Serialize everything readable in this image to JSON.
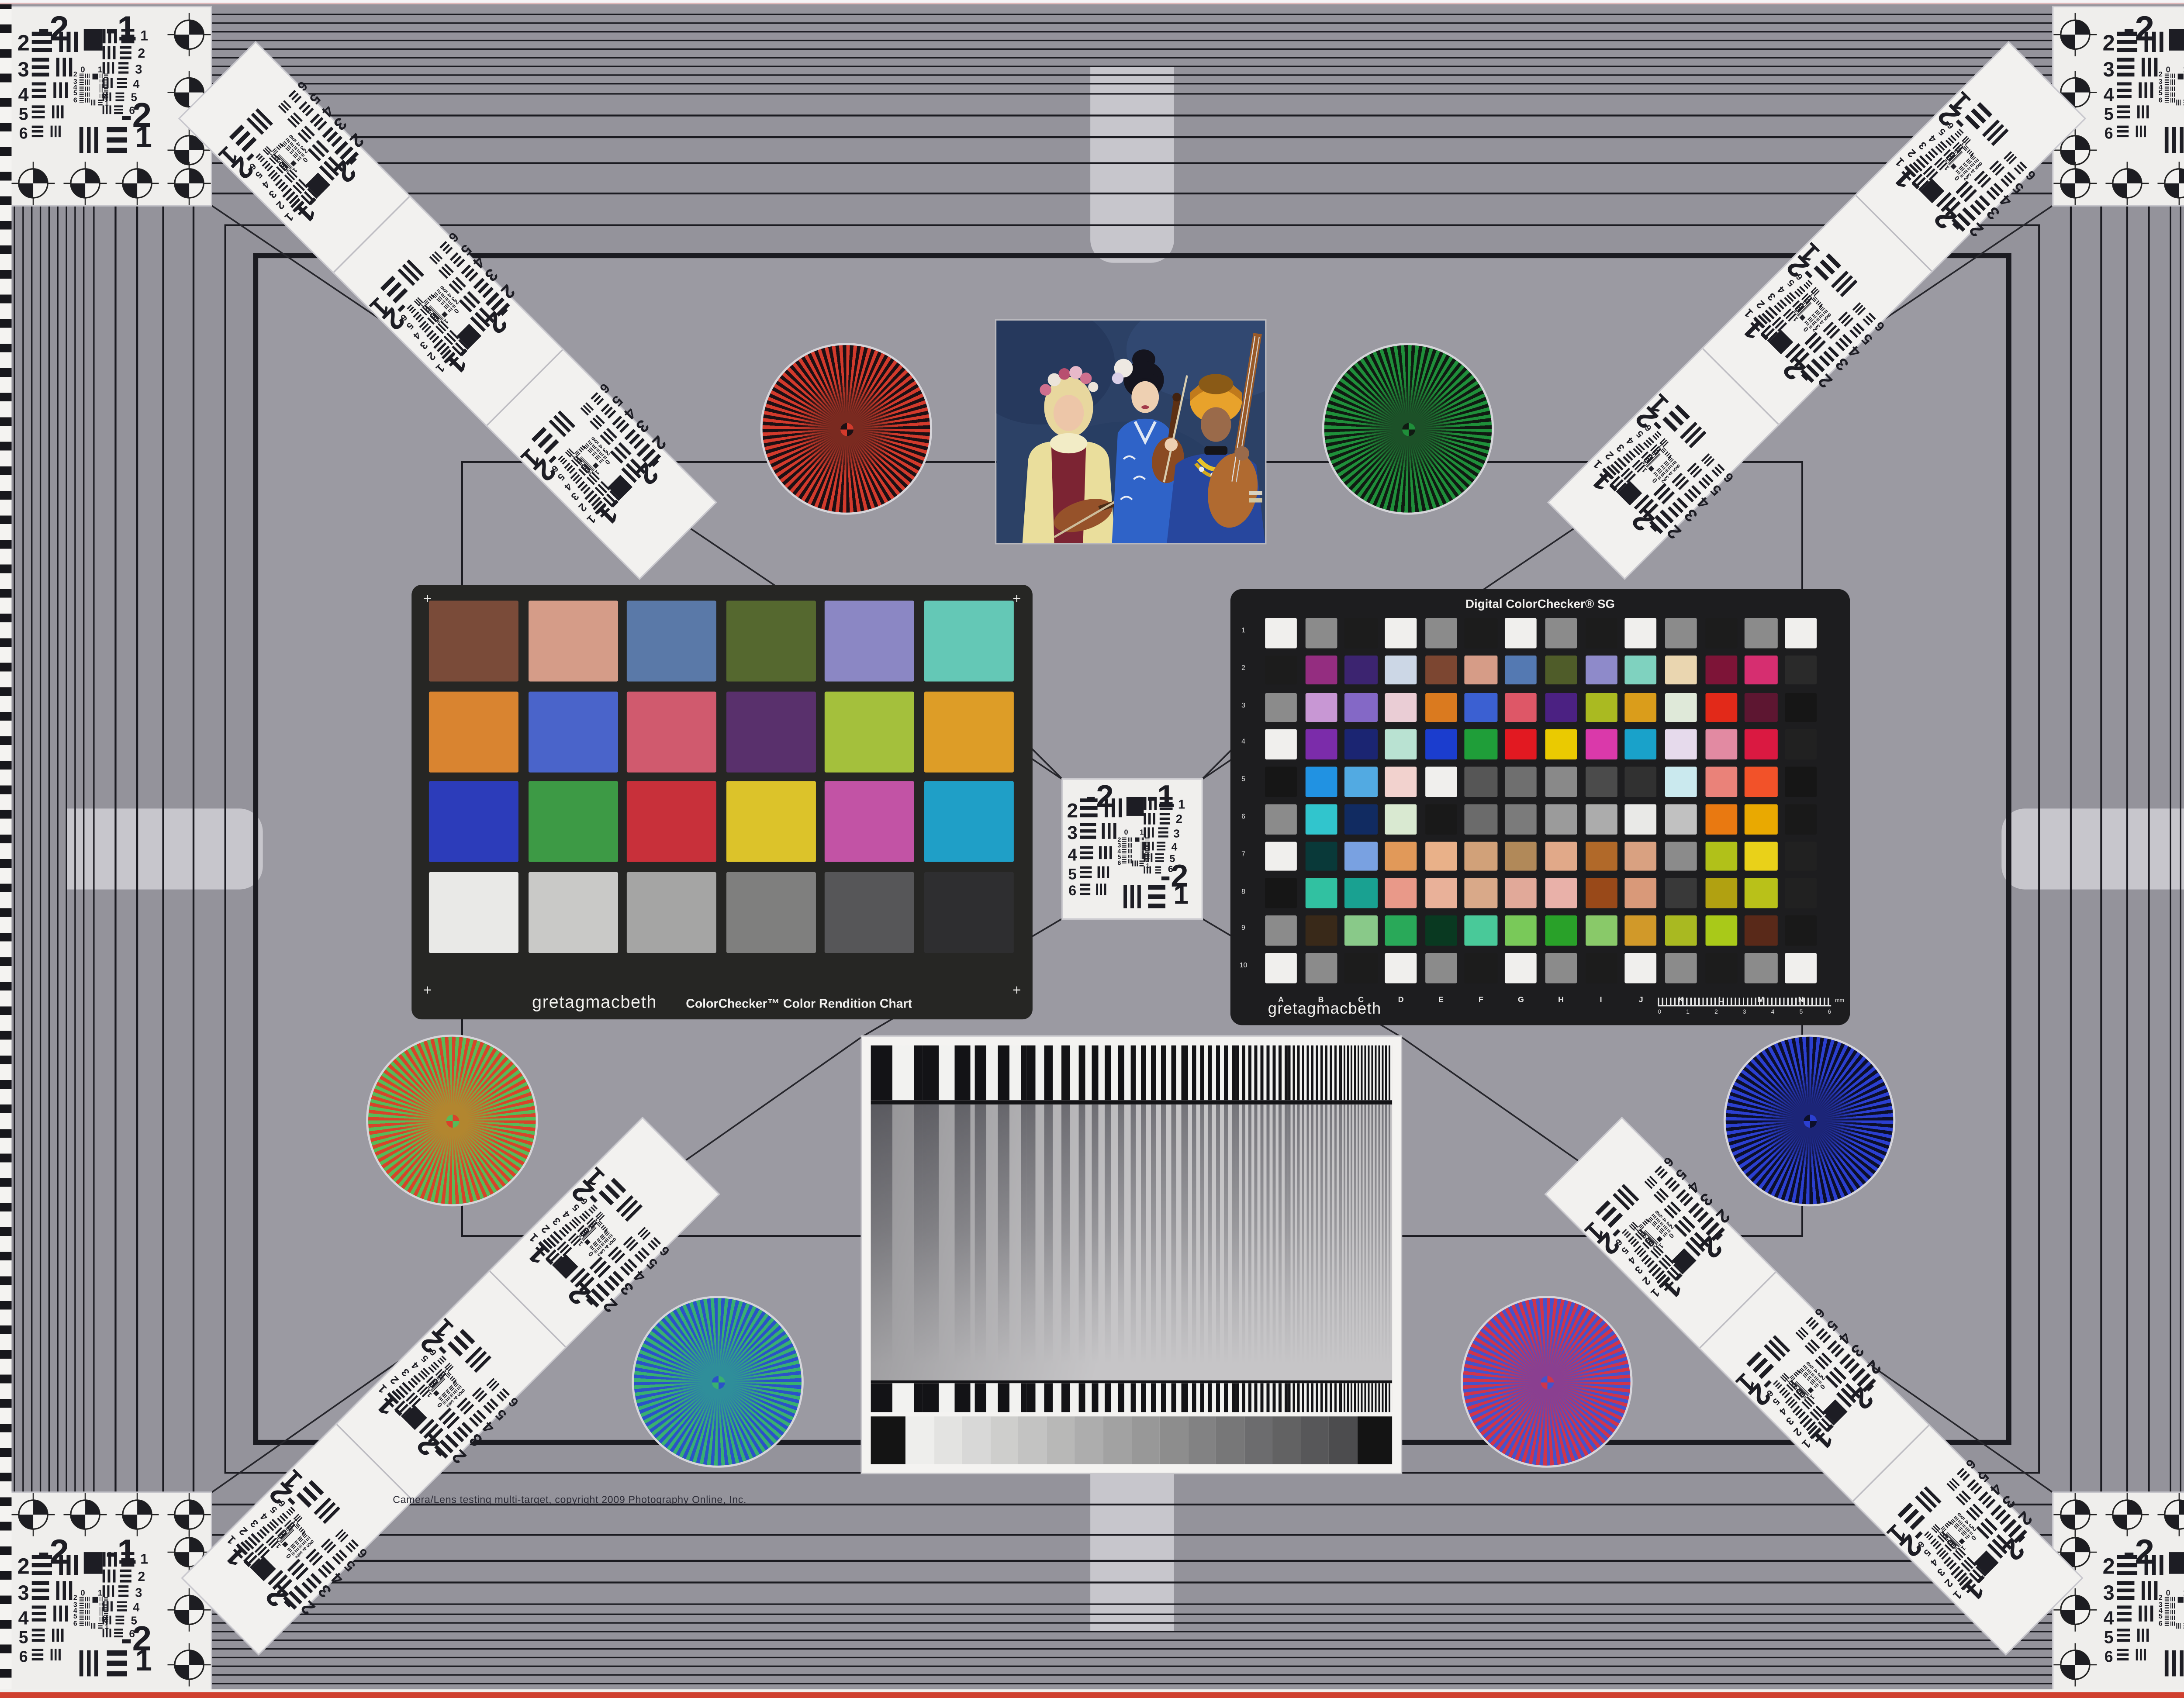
{
  "copyright": "Camera/Lens testing multi-target, copyright 2009 Photography Online, Inc.",
  "colors": {
    "background": "#9b9aa2",
    "outer_band": "#94939b",
    "frame_ink": "#1b1b21",
    "panel_white": "#efeeec",
    "tab_gray": "#c7c6cc",
    "edge_red": "#cf3f2e",
    "cc_panel_dark": "#262624",
    "sg_panel_dark": "#1d1d1f"
  },
  "usaf": {
    "top_left_label": "-2",
    "top_right_label": "-1",
    "left_rows": [
      "2",
      "3",
      "4",
      "5",
      "6"
    ],
    "right_rows": [
      "1",
      "2",
      "3",
      "4",
      "5",
      "6"
    ],
    "center_top": [
      "0",
      "1"
    ],
    "center_rows": [
      "2",
      "3",
      "4",
      "5",
      "6"
    ],
    "center_br": [
      "0",
      "1"
    ],
    "bottom_right_major": "-2",
    "bottom_right_minor": "1"
  },
  "colorchecker": {
    "brand": "gretagmacbeth",
    "title": "ColorChecker™ Color Rendition Chart",
    "corner_mark": "+",
    "patches": [
      [
        "#7a4b39",
        "#d59c88",
        "#5a79a8",
        "#55682f",
        "#8b87c4",
        "#64c8b6"
      ],
      [
        "#d98430",
        "#4a64ca",
        "#d05a6e",
        "#59306c",
        "#a4c03c",
        "#dd9d27"
      ],
      [
        "#2c3cba",
        "#3d9a45",
        "#c8303a",
        "#dcc32a",
        "#c253a5",
        "#1f9fc7"
      ],
      [
        "#e9e9e7",
        "#c9c9c7",
        "#a5a5a4",
        "#7f7f7e",
        "#565658",
        "#2e2e30"
      ]
    ]
  },
  "sg": {
    "title": "Digital ColorChecker® SG",
    "brand": "gretagmacbeth",
    "row_labels": [
      "1",
      "2",
      "3",
      "4",
      "5",
      "6",
      "7",
      "8",
      "9",
      "10"
    ],
    "col_labels": [
      "A",
      "B",
      "C",
      "D",
      "E",
      "F",
      "G",
      "H",
      "I",
      "J",
      "K",
      "L",
      "M",
      "N"
    ],
    "ruler_numbers": [
      "0",
      "1",
      "2",
      "3",
      "4",
      "5",
      "6"
    ],
    "ruler_unit": "mm",
    "patches": [
      [
        "#f0efed",
        "#8b8b8b",
        "#1c1c1c",
        "#f0efed",
        "#8b8b8b",
        "#1c1c1c",
        "#f0efed",
        "#8b8b8b",
        "#1c1c1c",
        "#f0efed",
        "#8b8b8b",
        "#1c1c1c",
        "#8b8b8b",
        "#f0efed"
      ],
      [
        "#1c1c1c",
        "#942d80",
        "#3c2470",
        "#ccd7e6",
        "#7c4631",
        "#d69c87",
        "#5479b2",
        "#4f5c29",
        "#8e8aca",
        "#7fd2bf",
        "#ead6b0",
        "#7d1437",
        "#d62e70",
        "#2a2a2a"
      ],
      [
        "#8b8b8b",
        "#c897d4",
        "#8468c6",
        "#eacdd5",
        "#da7a1f",
        "#3b60d2",
        "#de5767",
        "#4b2182",
        "#aaba21",
        "#da9d1b",
        "#dfe9d9",
        "#e22919",
        "#5d1631",
        "#161616"
      ],
      [
        "#f0efed",
        "#7b2caa",
        "#1b2572",
        "#b9e2d2",
        "#1b3dce",
        "#1f9e39",
        "#e21921",
        "#eaca01",
        "#da39aa",
        "#19a2ca",
        "#e6daec",
        "#e28aa2",
        "#da1941",
        "#212121"
      ],
      [
        "#161616",
        "#2192e2",
        "#52aae2",
        "#f2d2ce",
        "#f0efed",
        "#565656",
        "#6f6f6f",
        "#898989",
        "#4b4b4b",
        "#313131",
        "#cae9ee",
        "#ea8279",
        "#f25229",
        "#161616"
      ],
      [
        "#8b8b8b",
        "#31c5cd",
        "#112b61",
        "#d9e9d1",
        "#191919",
        "#6b6b6b",
        "#7b7b7b",
        "#9b9b9b",
        "#acacac",
        "#e9e9e7",
        "#c1c1c1",
        "#e97911",
        "#e9a901",
        "#191919"
      ],
      [
        "#f0efed",
        "#093939",
        "#79a1e1",
        "#e19959",
        "#e9b189",
        "#d1a179",
        "#b18959",
        "#e1a989",
        "#b16929",
        "#d9a181",
        "#8b8b8b",
        "#b1c119",
        "#e9d119",
        "#212121"
      ],
      [
        "#161616",
        "#31c1a1",
        "#19a191",
        "#e99989",
        "#e9b199",
        "#d9a989",
        "#e1a999",
        "#e9b1a9",
        "#994919",
        "#d99979",
        "#393939",
        "#b1a111",
        "#b9c119",
        "#212121"
      ],
      [
        "#8b8b8b",
        "#392919",
        "#89c989",
        "#29a959",
        "#093921",
        "#49c999",
        "#79c959",
        "#29a129",
        "#89c969",
        "#d19929",
        "#a9b921",
        "#a9c919",
        "#592919",
        "#191919"
      ],
      [
        "#f0efed",
        "#8b8b8b",
        "#1c1c1c",
        "#f0efed",
        "#8b8b8b",
        "#1c1c1c",
        "#f0efed",
        "#8b8b8b",
        "#1c1c1c",
        "#f0efed",
        "#8b8b8b",
        "#1c1c1c",
        "#8b8b8b",
        "#f0efed"
      ]
    ]
  },
  "stars": [
    {
      "id": "star-red-black",
      "a": "#d23a2c",
      "b": "#1c1014",
      "mix": "#7a2a20"
    },
    {
      "id": "star-green-black",
      "a": "#1f8f3a",
      "b": "#101a12",
      "mix": "#1c5128"
    },
    {
      "id": "star-red-green",
      "a": "#d8432a",
      "b": "#57bb58",
      "mix": "#b2862f"
    },
    {
      "id": "star-blue-black",
      "a": "#2b3fd0",
      "b": "#0c0f2a",
      "mix": "#1c2578"
    },
    {
      "id": "star-green-blue",
      "a": "#38b070",
      "b": "#2b52c8",
      "mix": "#2f8e9a"
    },
    {
      "id": "star-red-blue",
      "a": "#d0354a",
      "b": "#4553cc",
      "mix": "#8a3f90"
    }
  ]
}
